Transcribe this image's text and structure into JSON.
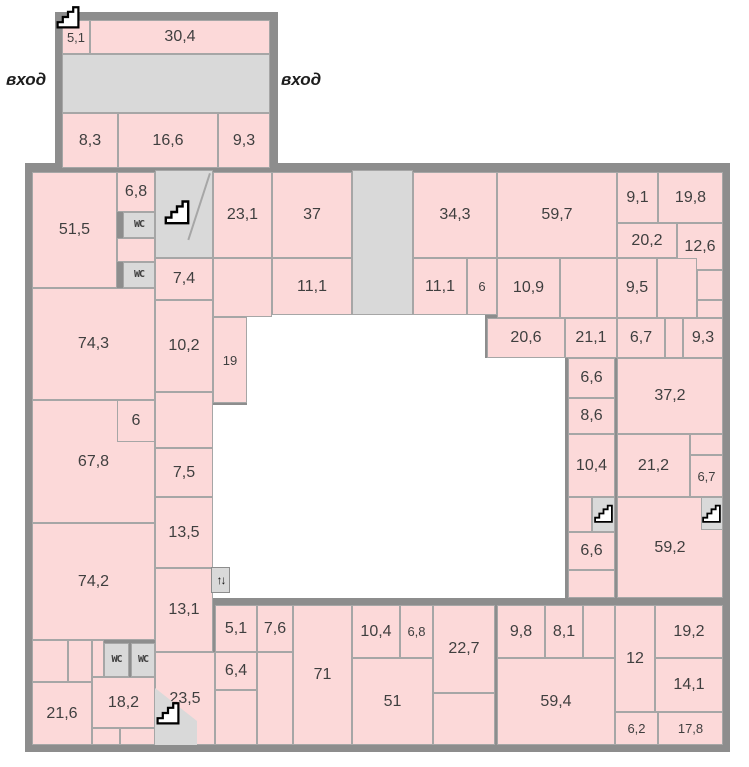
{
  "plan": {
    "entrance_left": "вход",
    "entrance_right": "вход",
    "wc_label": "WC",
    "elevator_label": "↑↓",
    "colors": {
      "room_fill": "#fcd9d9",
      "service_fill": "#d9d9d9",
      "wall": "#8d8d8d",
      "room_border": "#a6a6a6",
      "courtyard": "#ffffff",
      "label_text": "#3f3f3f"
    },
    "rooms": [
      {
        "label": "5,1",
        "x": 62,
        "y": 20,
        "w": 28,
        "h": 34,
        "kind": "pink"
      },
      {
        "label": "30,4",
        "x": 90,
        "y": 20,
        "w": 180,
        "h": 34,
        "kind": "pink"
      },
      {
        "label": "",
        "x": 62,
        "y": 54,
        "w": 208,
        "h": 59,
        "kind": "service"
      },
      {
        "label": "8,3",
        "x": 62,
        "y": 113,
        "w": 56,
        "h": 55,
        "kind": "pink"
      },
      {
        "label": "16,6",
        "x": 118,
        "y": 113,
        "w": 100,
        "h": 55,
        "kind": "pink"
      },
      {
        "label": "9,3",
        "x": 218,
        "y": 113,
        "w": 52,
        "h": 55,
        "kind": "pink"
      },
      {
        "label": "51,5",
        "x": 32,
        "y": 172,
        "w": 85,
        "h": 116,
        "kind": "pink"
      },
      {
        "label": "6,8",
        "x": 117,
        "y": 172,
        "w": 38,
        "h": 40,
        "kind": "pink"
      },
      {
        "label": "WC",
        "x": 123,
        "y": 212,
        "w": 32,
        "h": 26,
        "kind": "wc"
      },
      {
        "label": "",
        "x": 117,
        "y": 238,
        "w": 38,
        "h": 24,
        "kind": "pink"
      },
      {
        "label": "WC",
        "x": 123,
        "y": 262,
        "w": 32,
        "h": 26,
        "kind": "wc"
      },
      {
        "label": "",
        "x": 155,
        "y": 170,
        "w": 58,
        "h": 88,
        "kind": "service"
      },
      {
        "label": "23,1",
        "x": 213,
        "y": 172,
        "w": 59,
        "h": 86,
        "kind": "pink"
      },
      {
        "label": "37",
        "x": 272,
        "y": 172,
        "w": 80,
        "h": 86,
        "kind": "pink"
      },
      {
        "label": "",
        "x": 352,
        "y": 170,
        "w": 61,
        "h": 145,
        "kind": "service"
      },
      {
        "label": "34,3",
        "x": 413,
        "y": 172,
        "w": 84,
        "h": 86,
        "kind": "pink"
      },
      {
        "label": "59,7",
        "x": 497,
        "y": 172,
        "w": 120,
        "h": 86,
        "kind": "pink"
      },
      {
        "label": "9,1",
        "x": 617,
        "y": 172,
        "w": 41,
        "h": 51,
        "kind": "pink"
      },
      {
        "label": "19,8",
        "x": 658,
        "y": 172,
        "w": 65,
        "h": 51,
        "kind": "pink"
      },
      {
        "label": "20,2",
        "x": 617,
        "y": 223,
        "w": 60,
        "h": 35,
        "kind": "pink"
      },
      {
        "label": "12,6",
        "x": 677,
        "y": 223,
        "w": 46,
        "h": 47,
        "kind": "pink"
      },
      {
        "label": "7,4",
        "x": 155,
        "y": 258,
        "w": 58,
        "h": 42,
        "kind": "pink"
      },
      {
        "label": "",
        "x": 213,
        "y": 258,
        "w": 59,
        "h": 59,
        "kind": "pink"
      },
      {
        "label": "11,1",
        "x": 272,
        "y": 258,
        "w": 80,
        "h": 57,
        "kind": "pink"
      },
      {
        "label": "11,1",
        "x": 413,
        "y": 258,
        "w": 54,
        "h": 57,
        "kind": "pink"
      },
      {
        "label": "6",
        "x": 467,
        "y": 258,
        "w": 30,
        "h": 57,
        "kind": "pink"
      },
      {
        "label": "10,9",
        "x": 497,
        "y": 258,
        "w": 63,
        "h": 60,
        "kind": "pink"
      },
      {
        "label": "",
        "x": 560,
        "y": 258,
        "w": 57,
        "h": 60,
        "kind": "pink"
      },
      {
        "label": "9,5",
        "x": 617,
        "y": 258,
        "w": 40,
        "h": 60,
        "kind": "pink"
      },
      {
        "label": "",
        "x": 657,
        "y": 258,
        "w": 40,
        "h": 60,
        "kind": "pink"
      },
      {
        "label": "",
        "x": 697,
        "y": 270,
        "w": 26,
        "h": 30,
        "kind": "pink"
      },
      {
        "label": "",
        "x": 697,
        "y": 300,
        "w": 26,
        "h": 18,
        "kind": "pink"
      },
      {
        "label": "20,6",
        "x": 487,
        "y": 318,
        "w": 78,
        "h": 40,
        "kind": "pink"
      },
      {
        "label": "21,1",
        "x": 565,
        "y": 318,
        "w": 52,
        "h": 40,
        "kind": "pink"
      },
      {
        "label": "6,7",
        "x": 617,
        "y": 318,
        "w": 48,
        "h": 40,
        "kind": "pink"
      },
      {
        "label": "",
        "x": 665,
        "y": 318,
        "w": 18,
        "h": 40,
        "kind": "pink"
      },
      {
        "label": "9,3",
        "x": 683,
        "y": 318,
        "w": 40,
        "h": 40,
        "kind": "pink"
      },
      {
        "label": "74,3",
        "x": 32,
        "y": 288,
        "w": 123,
        "h": 112,
        "kind": "pink"
      },
      {
        "label": "10,2",
        "x": 155,
        "y": 300,
        "w": 58,
        "h": 92,
        "kind": "pink"
      },
      {
        "label": "19",
        "x": 213,
        "y": 317,
        "w": 34,
        "h": 86,
        "kind": "pink"
      },
      {
        "label": "",
        "x": 155,
        "y": 392,
        "w": 58,
        "h": 56,
        "kind": "pink"
      },
      {
        "label": "67,8",
        "x": 32,
        "y": 400,
        "w": 123,
        "h": 123,
        "kind": "pink"
      },
      {
        "label": "6",
        "x": 117,
        "y": 400,
        "w": 38,
        "h": 42,
        "kind": "pink"
      },
      {
        "label": "7,5",
        "x": 155,
        "y": 448,
        "w": 58,
        "h": 49,
        "kind": "pink"
      },
      {
        "label": "13,5",
        "x": 155,
        "y": 497,
        "w": 58,
        "h": 71,
        "kind": "pink"
      },
      {
        "label": "74,2",
        "x": 32,
        "y": 523,
        "w": 123,
        "h": 117,
        "kind": "pink"
      },
      {
        "label": "13,1",
        "x": 155,
        "y": 568,
        "w": 58,
        "h": 84,
        "kind": "pink"
      },
      {
        "label": "6,6",
        "x": 568,
        "y": 358,
        "w": 47,
        "h": 40,
        "kind": "pink"
      },
      {
        "label": "37,2",
        "x": 617,
        "y": 358,
        "w": 106,
        "h": 76,
        "kind": "pink"
      },
      {
        "label": "8,6",
        "x": 568,
        "y": 398,
        "w": 47,
        "h": 36,
        "kind": "pink"
      },
      {
        "label": "10,4",
        "x": 568,
        "y": 434,
        "w": 47,
        "h": 63,
        "kind": "pink"
      },
      {
        "label": "21,2",
        "x": 617,
        "y": 434,
        "w": 73,
        "h": 63,
        "kind": "pink"
      },
      {
        "label": "",
        "x": 690,
        "y": 434,
        "w": 33,
        "h": 21,
        "kind": "pink"
      },
      {
        "label": "6,7",
        "x": 690,
        "y": 455,
        "w": 33,
        "h": 42,
        "kind": "pink"
      },
      {
        "label": "",
        "x": 568,
        "y": 497,
        "w": 24,
        "h": 35,
        "kind": "pink"
      },
      {
        "label": "59,2",
        "x": 617,
        "y": 497,
        "w": 106,
        "h": 101,
        "kind": "pink"
      },
      {
        "label": "",
        "x": 592,
        "y": 497,
        "w": 23,
        "h": 35,
        "kind": "service"
      },
      {
        "label": "",
        "x": 701,
        "y": 497,
        "w": 22,
        "h": 33,
        "kind": "service"
      },
      {
        "label": "6,6",
        "x": 568,
        "y": 532,
        "w": 47,
        "h": 38,
        "kind": "pink"
      },
      {
        "label": "",
        "x": 568,
        "y": 570,
        "w": 47,
        "h": 28,
        "kind": "pink"
      },
      {
        "label": "5,1",
        "x": 215,
        "y": 605,
        "w": 42,
        "h": 47,
        "kind": "pink"
      },
      {
        "label": "7,6",
        "x": 257,
        "y": 605,
        "w": 36,
        "h": 47,
        "kind": "pink"
      },
      {
        "label": "71",
        "x": 293,
        "y": 605,
        "w": 59,
        "h": 140,
        "kind": "pink"
      },
      {
        "label": "6,4",
        "x": 215,
        "y": 652,
        "w": 42,
        "h": 38,
        "kind": "pink"
      },
      {
        "label": "",
        "x": 215,
        "y": 690,
        "w": 42,
        "h": 55,
        "kind": "pink"
      },
      {
        "label": "",
        "x": 257,
        "y": 652,
        "w": 36,
        "h": 93,
        "kind": "pink"
      },
      {
        "label": "10,4",
        "x": 352,
        "y": 605,
        "w": 48,
        "h": 53,
        "kind": "pink"
      },
      {
        "label": "6,8",
        "x": 400,
        "y": 605,
        "w": 33,
        "h": 53,
        "kind": "pink"
      },
      {
        "label": "22,7",
        "x": 433,
        "y": 605,
        "w": 62,
        "h": 88,
        "kind": "pink"
      },
      {
        "label": "51",
        "x": 352,
        "y": 658,
        "w": 81,
        "h": 87,
        "kind": "pink"
      },
      {
        "label": "",
        "x": 433,
        "y": 693,
        "w": 62,
        "h": 52,
        "kind": "pink"
      },
      {
        "label": "9,8",
        "x": 497,
        "y": 605,
        "w": 48,
        "h": 53,
        "kind": "pink"
      },
      {
        "label": "8,1",
        "x": 545,
        "y": 605,
        "w": 38,
        "h": 53,
        "kind": "pink"
      },
      {
        "label": "",
        "x": 583,
        "y": 605,
        "w": 32,
        "h": 53,
        "kind": "pink"
      },
      {
        "label": "59,4",
        "x": 497,
        "y": 658,
        "w": 118,
        "h": 87,
        "kind": "pink"
      },
      {
        "label": "12",
        "x": 615,
        "y": 605,
        "w": 40,
        "h": 107,
        "kind": "pink"
      },
      {
        "label": "19,2",
        "x": 655,
        "y": 605,
        "w": 68,
        "h": 53,
        "kind": "pink"
      },
      {
        "label": "14,1",
        "x": 655,
        "y": 658,
        "w": 68,
        "h": 54,
        "kind": "pink"
      },
      {
        "label": "6,2",
        "x": 615,
        "y": 712,
        "w": 43,
        "h": 33,
        "kind": "pink"
      },
      {
        "label": "17,8",
        "x": 658,
        "y": 712,
        "w": 65,
        "h": 33,
        "kind": "pink"
      },
      {
        "label": "",
        "x": 32,
        "y": 640,
        "w": 36,
        "h": 42,
        "kind": "pink"
      },
      {
        "label": "",
        "x": 68,
        "y": 640,
        "w": 24,
        "h": 42,
        "kind": "pink"
      },
      {
        "label": "21,6",
        "x": 32,
        "y": 682,
        "w": 60,
        "h": 63,
        "kind": "pink"
      },
      {
        "label": "",
        "x": 92,
        "y": 640,
        "w": 12,
        "h": 37,
        "kind": "pink"
      },
      {
        "label": "WC",
        "x": 104,
        "y": 643,
        "w": 25,
        "h": 34,
        "kind": "wc"
      },
      {
        "label": "WC",
        "x": 131,
        "y": 643,
        "w": 24,
        "h": 34,
        "kind": "wc"
      },
      {
        "label": "18,2",
        "x": 92,
        "y": 677,
        "w": 63,
        "h": 51,
        "kind": "pink"
      },
      {
        "label": "",
        "x": 92,
        "y": 728,
        "w": 28,
        "h": 17,
        "kind": "pink"
      },
      {
        "label": "",
        "x": 120,
        "y": 728,
        "w": 35,
        "h": 17,
        "kind": "pink"
      },
      {
        "label": "23,5",
        "x": 155,
        "y": 652,
        "w": 60,
        "h": 93,
        "kind": "pink"
      },
      {
        "label": "",
        "x": 155,
        "y": 688,
        "w": 42,
        "h": 57,
        "kind": "service",
        "shape": "wedge"
      }
    ],
    "stairs_icons": [
      {
        "x": 55,
        "y": 4,
        "size": 26
      },
      {
        "x": 163,
        "y": 198,
        "size": 28
      },
      {
        "x": 593,
        "y": 503,
        "size": 21
      },
      {
        "x": 701,
        "y": 503,
        "size": 21
      },
      {
        "x": 155,
        "y": 700,
        "size": 26
      }
    ],
    "elevator": {
      "x": 211,
      "y": 567,
      "w": 19,
      "h": 26
    }
  }
}
